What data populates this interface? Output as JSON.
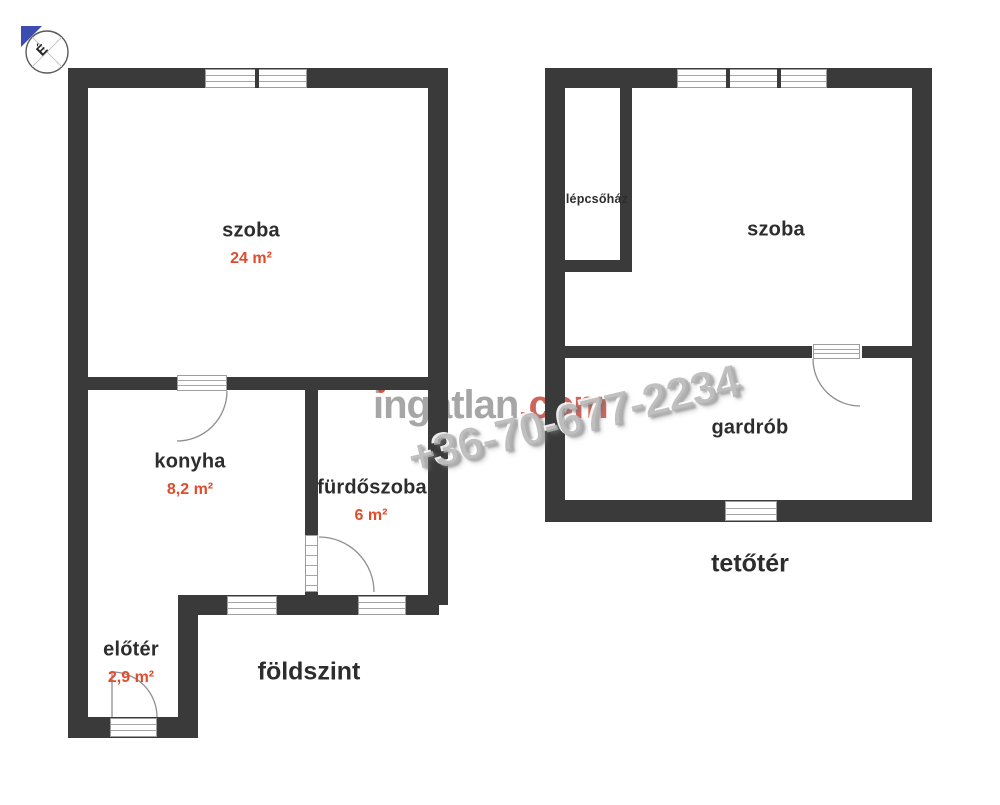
{
  "compass": {
    "north_label": "É"
  },
  "watermark": {
    "brand": "ingatlan",
    "brand_suffix": ".com",
    "phone": "+36-70-677-2234"
  },
  "floors": {
    "ground": {
      "label": "földszint",
      "rooms": {
        "szoba": {
          "name": "szoba",
          "area": "24 m²"
        },
        "konyha": {
          "name": "konyha",
          "area": "8,2 m²"
        },
        "furdoszoba": {
          "name": "fürdőszoba",
          "area": "6 m²"
        },
        "eloter": {
          "name": "előtér",
          "area": "2,9 m²"
        }
      }
    },
    "attic": {
      "label": "tetőtér",
      "rooms": {
        "lepcsohaz": {
          "name": "lépcsőház"
        },
        "szoba": {
          "name": "szoba"
        },
        "gardrob": {
          "name": "gardrób"
        }
      }
    }
  },
  "colors": {
    "wall": "#3a3a3a",
    "area_label": "#e04b2c",
    "compass_north": "#3c4cb0",
    "brand_gray": "#969696",
    "brand_red": "#c64a3e",
    "phone_gray": "#b2b2b2"
  }
}
